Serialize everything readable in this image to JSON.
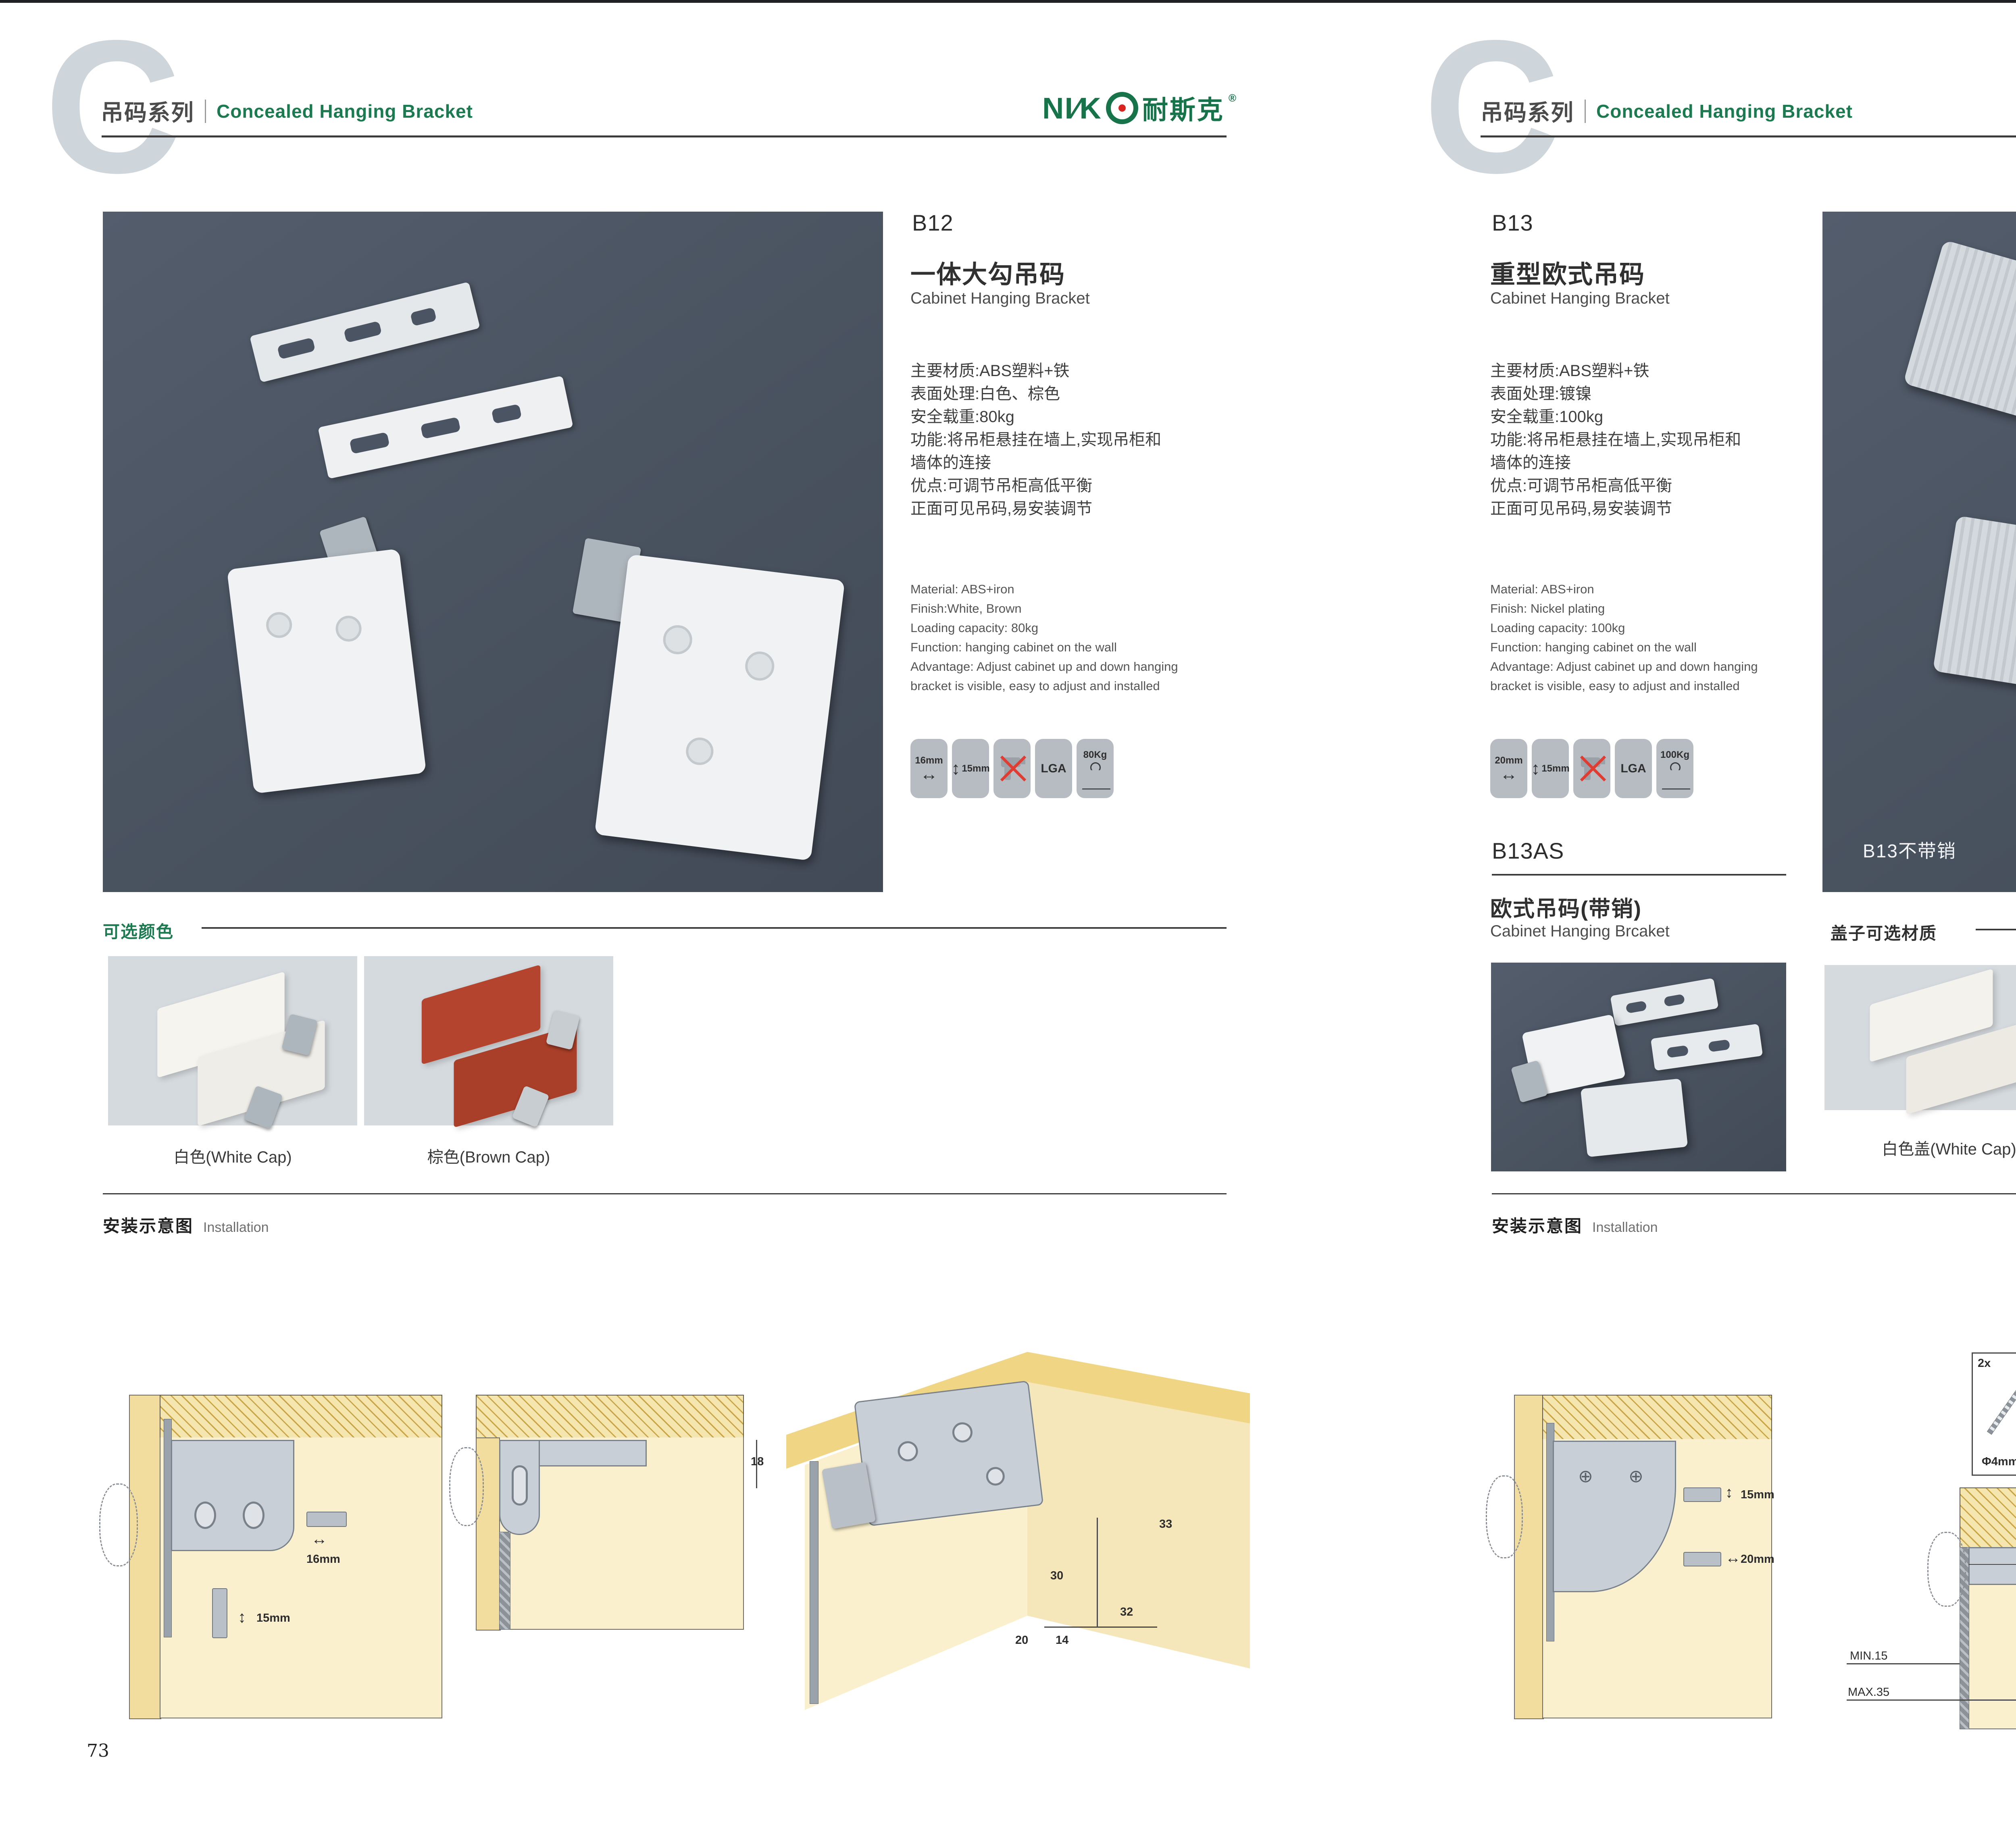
{
  "brand": {
    "latin": "NI∕K",
    "cn": "耐斯克",
    "reg": "®"
  },
  "page_left": {
    "header": {
      "watermark": "C",
      "series_cn": "吊码系列",
      "series_en": "Concealed Hanging Bracket"
    },
    "product": {
      "code": "B12",
      "name_cn": "一体大勾吊码",
      "name_en": "Cabinet Hanging Bracket",
      "specs_cn": [
        "主要材质:ABS塑料+铁",
        "表面处理:白色、棕色",
        "安全载重:80kg",
        "功能:将吊柜悬挂在墙上,实现吊柜和",
        "墙体的连接",
        "优点:可调节吊柜高低平衡",
        "正面可见吊码,易安装调节"
      ],
      "specs_en": [
        "Material: ABS+iron",
        "Finish:White, Brown",
        "Loading capacity: 80kg",
        "Function: hanging cabinet on the wall",
        "Advantage: Adjust cabinet up and down hanging",
        "bracket is visible, easy to adjust and installed"
      ],
      "badges": [
        {
          "label": "16mm"
        },
        {
          "label": "15mm"
        },
        {
          "label": ""
        },
        {
          "label": "LGA"
        },
        {
          "label": "80Kg"
        }
      ]
    },
    "colors": {
      "title": "可选颜色",
      "options": [
        {
          "label": "白色(White Cap)"
        },
        {
          "label": "棕色(Brown Cap)"
        }
      ]
    },
    "installation": {
      "title_cn": "安装示意图",
      "title_en": "Installation",
      "d1": {
        "w": "16mm",
        "h": "15mm"
      },
      "d2": {
        "dim": "18"
      },
      "d3": {
        "dims": [
          "33",
          "30",
          "32",
          "20",
          "14"
        ]
      }
    },
    "page_number": "73"
  },
  "page_right": {
    "header": {
      "watermark": "C",
      "series_cn": "吊码系列",
      "series_en": "Concealed Hanging Bracket"
    },
    "product": {
      "code": "B13",
      "name_cn": "重型欧式吊码",
      "name_en": "Cabinet Hanging Bracket",
      "specs_cn": [
        "主要材质:ABS塑料+铁",
        "表面处理:镀镍",
        "安全载重:100kg",
        "功能:将吊柜悬挂在墙上,实现吊柜和",
        "墙体的连接",
        "优点:可调节吊柜高低平衡",
        "正面可见吊码,易安装调节"
      ],
      "specs_en": [
        "Material: ABS+iron",
        "Finish: Nickel plating",
        "Loading capacity: 100kg",
        "Function: hanging cabinet on the wall",
        "Advantage: Adjust cabinet up and down hanging",
        "bracket is visible, easy to adjust and installed"
      ],
      "badges": [
        {
          "label": "20mm"
        },
        {
          "label": "15mm"
        },
        {
          "label": ""
        },
        {
          "label": "LGA"
        },
        {
          "label": "100Kg"
        }
      ],
      "photo_note": "B13不带销"
    },
    "sub_product": {
      "code": "B13AS",
      "name_cn": "欧式吊码(带销)",
      "name_en": "Cabinet Hanging Brcaket"
    },
    "caps": {
      "title": "盖子可选材质",
      "options": [
        {
          "label": "白色盖(White Cap)"
        },
        {
          "label": "灰色盖(Gray Cap)"
        }
      ]
    },
    "installation": {
      "title_cn": "安装示意图",
      "title_en": "Installation",
      "d1": {
        "h": "15mm",
        "w": "20mm"
      },
      "d2": {
        "count": "2x",
        "dia": "Φ4mm",
        "top": "18",
        "min": "MIN.15",
        "max": "MAX.35",
        "width": "58"
      },
      "d3": {
        "dims": [
          "16",
          "40",
          "RMAX4",
          "19",
          "32",
          "18"
        ]
      }
    },
    "page_number": "74"
  }
}
